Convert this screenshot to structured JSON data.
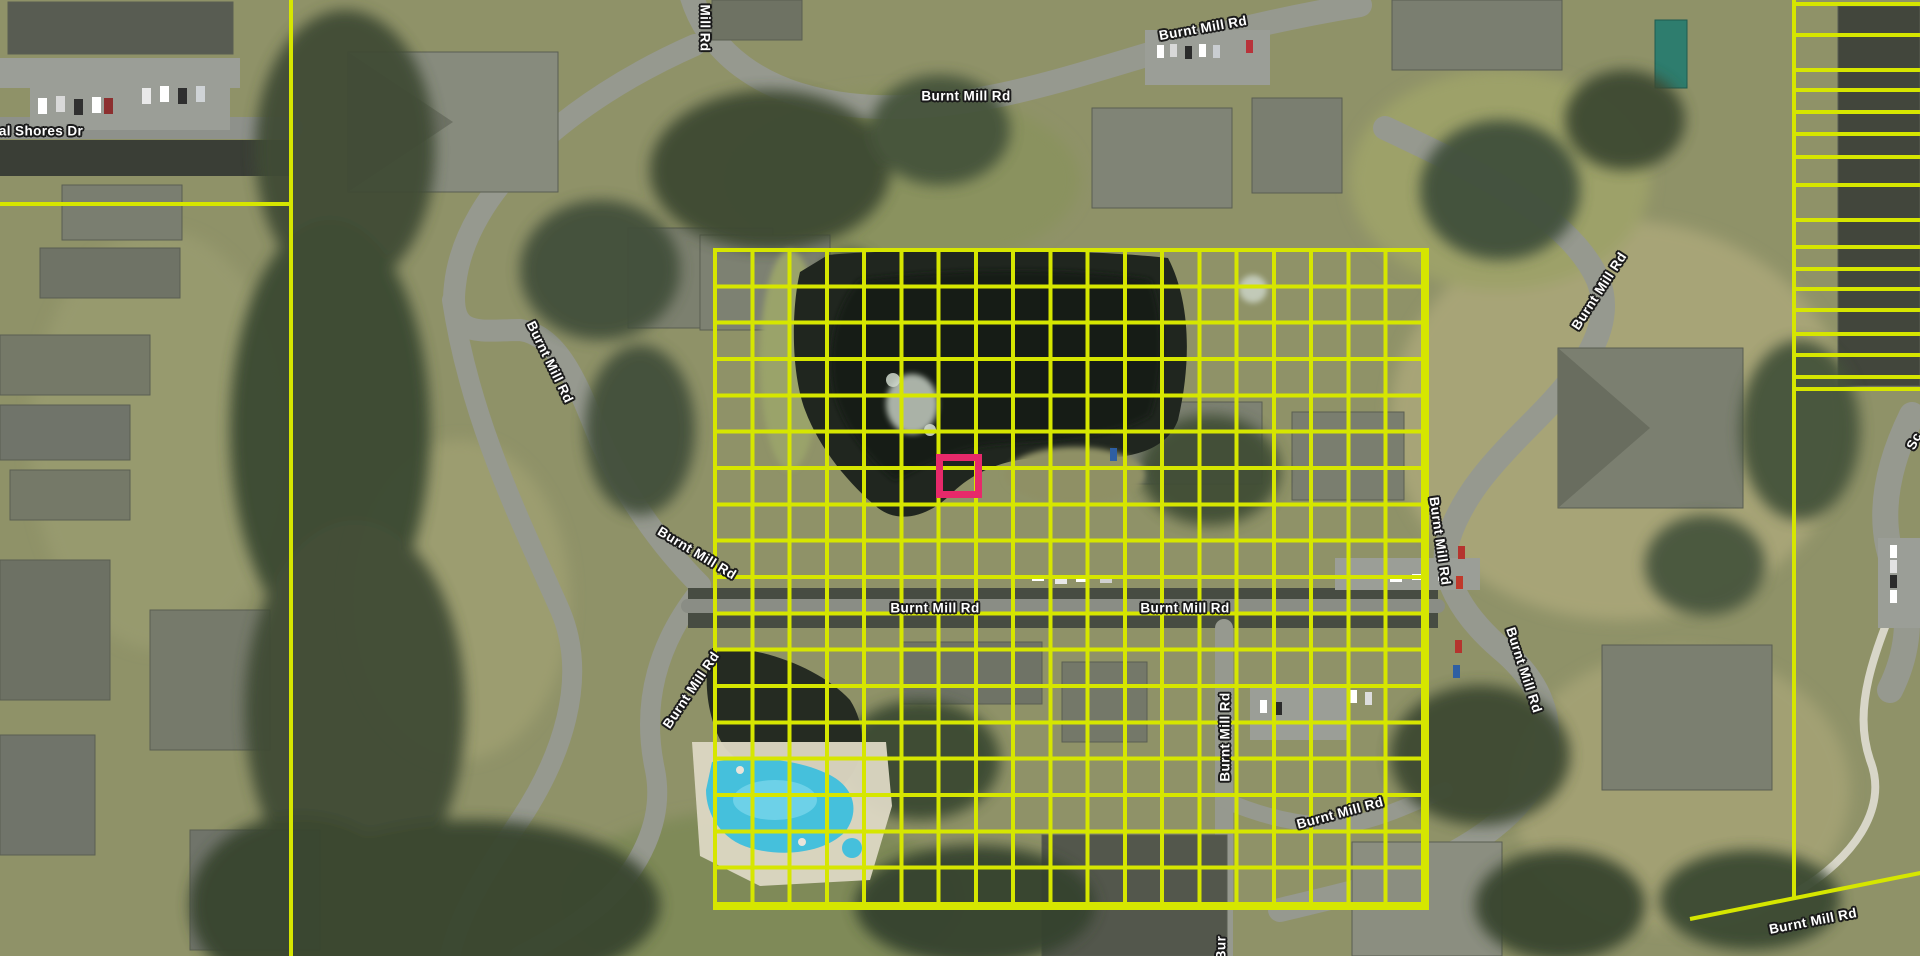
{
  "overlay": {
    "grid_color": "#d6e600",
    "highlight_color": "#e7296a",
    "tile_grid": {
      "left": 713,
      "top": 248,
      "width": 716,
      "height": 662,
      "cols": 19,
      "rows": 18,
      "line_thickness": 4
    },
    "highlighted_cell": {
      "left": 936,
      "top": 454,
      "width": 46,
      "height": 44,
      "border": 7
    },
    "parcel_boundaries": {
      "left_vertical_x": 289,
      "left_horizontal_y": 202,
      "left_horizontal_width": 293,
      "right_vertical_x": 1792,
      "right_vertical_height": 900,
      "right_lot_line_ys": [
        2,
        33,
        68,
        88,
        110,
        132,
        155,
        183,
        218,
        245,
        267,
        287,
        308,
        332,
        353,
        375,
        387
      ],
      "diagonal": {
        "x": 1690,
        "y": 917,
        "length": 236,
        "angle": -11.3
      }
    }
  },
  "street_labels": [
    {
      "text": "al Shores Dr",
      "x": 41,
      "y": 131,
      "rot": 0
    },
    {
      "text": "Mill Rd",
      "x": 705,
      "y": 28,
      "rot": 90
    },
    {
      "text": "Burnt Mill Rd",
      "x": 1203,
      "y": 28,
      "rot": -10
    },
    {
      "text": "Burnt Mill Rd",
      "x": 966,
      "y": 96,
      "rot": 0
    },
    {
      "text": "Burnt Mill Rd",
      "x": 550,
      "y": 362,
      "rot": 64
    },
    {
      "text": "Burnt Mill Rd",
      "x": 697,
      "y": 553,
      "rot": 31
    },
    {
      "text": "Burnt Mill Rd",
      "x": 691,
      "y": 690,
      "rot": -56
    },
    {
      "text": "Burnt Mill Rd",
      "x": 935,
      "y": 608,
      "rot": 0
    },
    {
      "text": "Burnt Mill Rd",
      "x": 1185,
      "y": 608,
      "rot": 0
    },
    {
      "text": "Burnt Mill Rd",
      "x": 1599,
      "y": 291,
      "rot": -57
    },
    {
      "text": "Burnt Mill Rd",
      "x": 1440,
      "y": 541,
      "rot": 82
    },
    {
      "text": "Burnt Mill Rd",
      "x": 1524,
      "y": 670,
      "rot": 72
    },
    {
      "text": "Burnt Mill Rd",
      "x": 1225,
      "y": 737,
      "rot": -90
    },
    {
      "text": "Burnt Mill Rd",
      "x": 1340,
      "y": 813,
      "rot": -15
    },
    {
      "text": "Burnt Mill Rd",
      "x": 1813,
      "y": 921,
      "rot": -11
    },
    {
      "text": "Bur",
      "x": 1221,
      "y": 948,
      "rot": -90
    },
    {
      "text": "Sc",
      "x": 1914,
      "y": 441,
      "rot": -63
    }
  ]
}
